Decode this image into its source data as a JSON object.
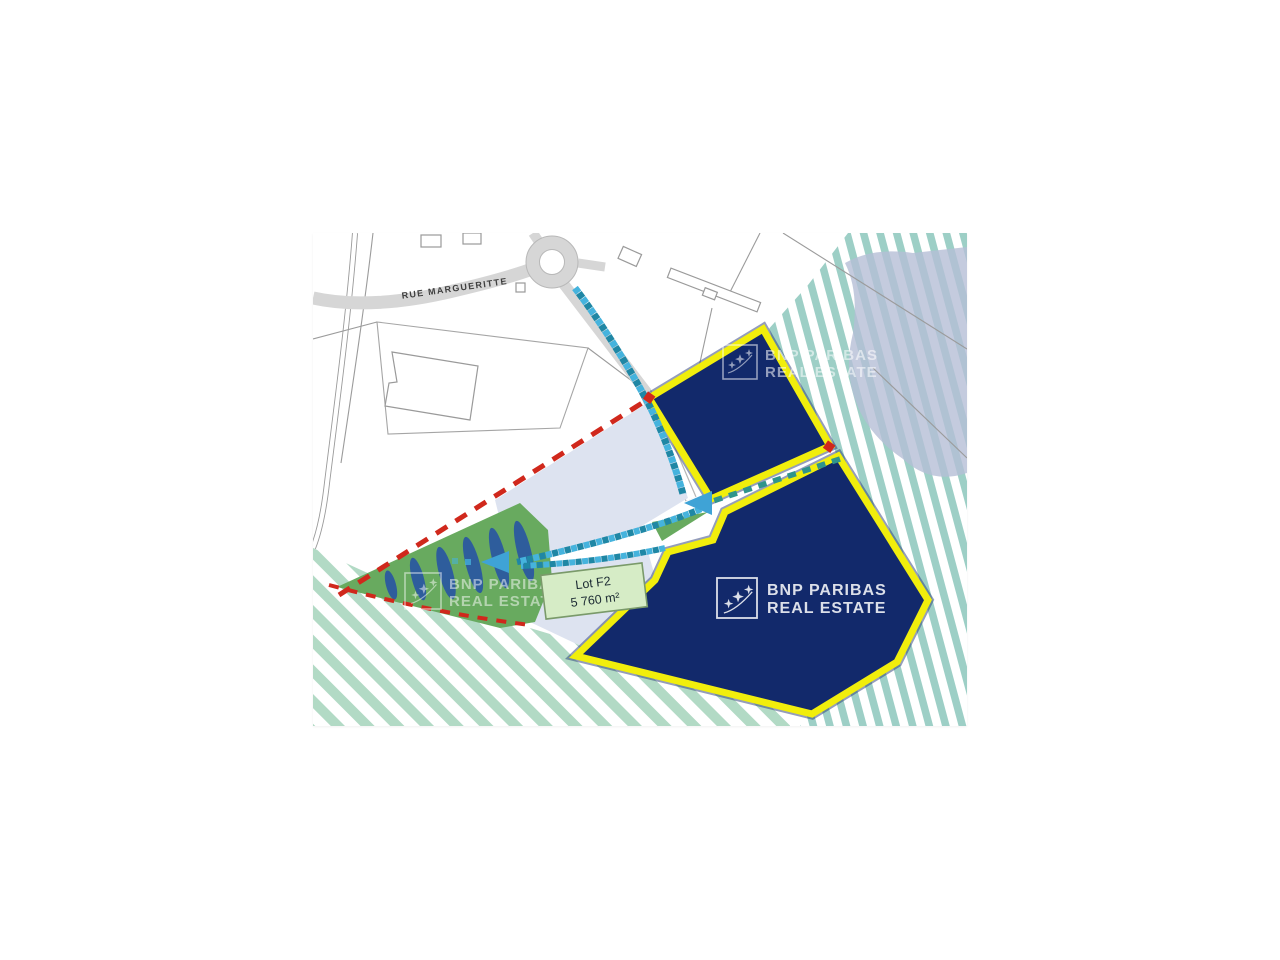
{
  "page": {
    "background": "#ffffff"
  },
  "map": {
    "street_label": "RUE MARGUERITTE",
    "lot_box": {
      "title": "Lot F2",
      "area": "5 760 m²"
    },
    "watermark": {
      "line1": "BNP PARIBAS",
      "line2": "REAL ESTATE"
    },
    "colors": {
      "lot_fill": "#12296b",
      "lot_outline": "#f1ee0c",
      "lot_halo": "#2a3c78",
      "parcel_light": "#dde3f0",
      "green_area": "#68aa5f",
      "tree_leaf": "#2e5d9c",
      "stripe_green": "#b2dac5",
      "stripe_teal": "#9dcfc6",
      "overlay_blob": "#b5bed6",
      "path_blue_light": "#45b3dd",
      "path_blue_dark": "#1f87a5",
      "corridor_dash": "#2f948c",
      "arrow_blue": "#3fa3d6",
      "boundary_red": "#d0281c",
      "road_fill": "#d6d6d6",
      "street_text": "#3f3f3f",
      "lot_box_fill": "#d6ecc6",
      "lot_box_border": "#7a9a6a",
      "lot_box_text": "#1c2b33",
      "watermark_color": "#ffffff"
    }
  }
}
